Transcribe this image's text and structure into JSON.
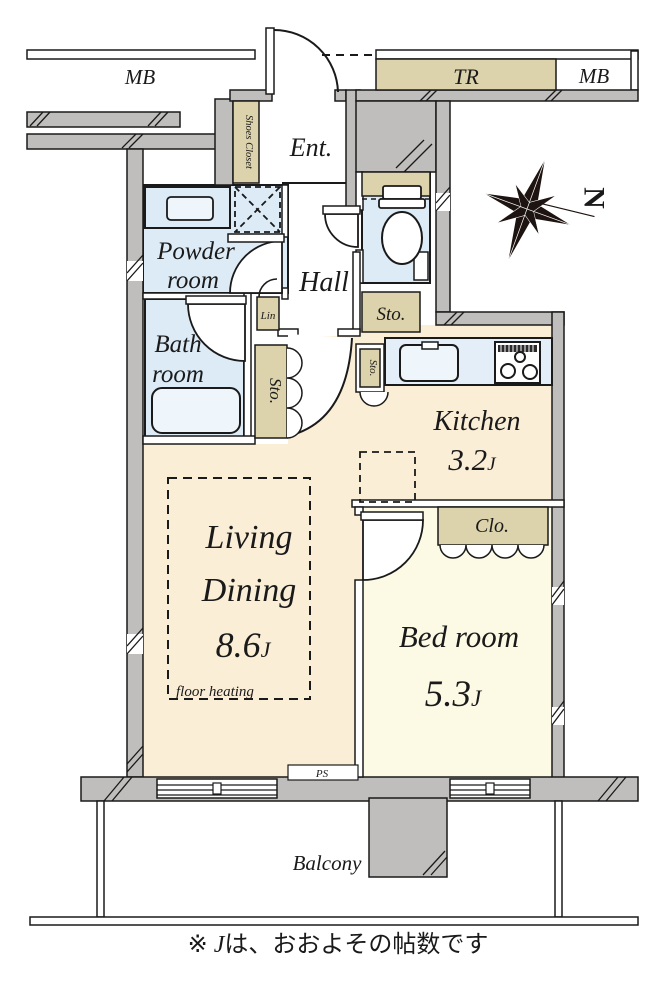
{
  "colors": {
    "floor_cream": "#fbeed6",
    "floor_ivory": "#fcf9e5",
    "wet_blue": "#dcebf6",
    "counter_blue": "#e4eef8",
    "fixture_blue": "#eef5fb",
    "storage_tan": "#dcd2ab",
    "wall_gray": "#bfbebc",
    "ink": "#1a1a1a"
  },
  "corridor": {
    "mb_left": "MB",
    "tr": "TR",
    "mb_right": "MB"
  },
  "compass": {
    "north": "N"
  },
  "rooms": {
    "entrance": {
      "label": "Ent."
    },
    "shoes_closet": {
      "label": "Shoes Closet"
    },
    "hall": {
      "label": "Hall"
    },
    "powder": {
      "line1": "Powder",
      "line2": "room"
    },
    "bath": {
      "line1": "Bath",
      "line2": "room"
    },
    "linen": {
      "label": "Lin"
    },
    "storage_hall": {
      "label": "Sto."
    },
    "storage_tall": {
      "label": "Sto."
    },
    "storage_kitchen": {
      "label": "Sto."
    },
    "kitchen": {
      "label": "Kitchen",
      "size": "3.2",
      "unit": "J"
    },
    "living_dining": {
      "line1": "Living",
      "line2": "Dining",
      "size": "8.6",
      "unit": "J",
      "note": "floor heating"
    },
    "bedroom": {
      "label": "Bed room",
      "size": "5.3",
      "unit": "J"
    },
    "closet": {
      "label": "Clo."
    },
    "pipe_space": {
      "label": "PS"
    },
    "balcony": {
      "label": "Balcony"
    }
  },
  "footnote": {
    "prefix": "※ ",
    "j": "J",
    "suffix": "は、おおよその帖数です"
  }
}
